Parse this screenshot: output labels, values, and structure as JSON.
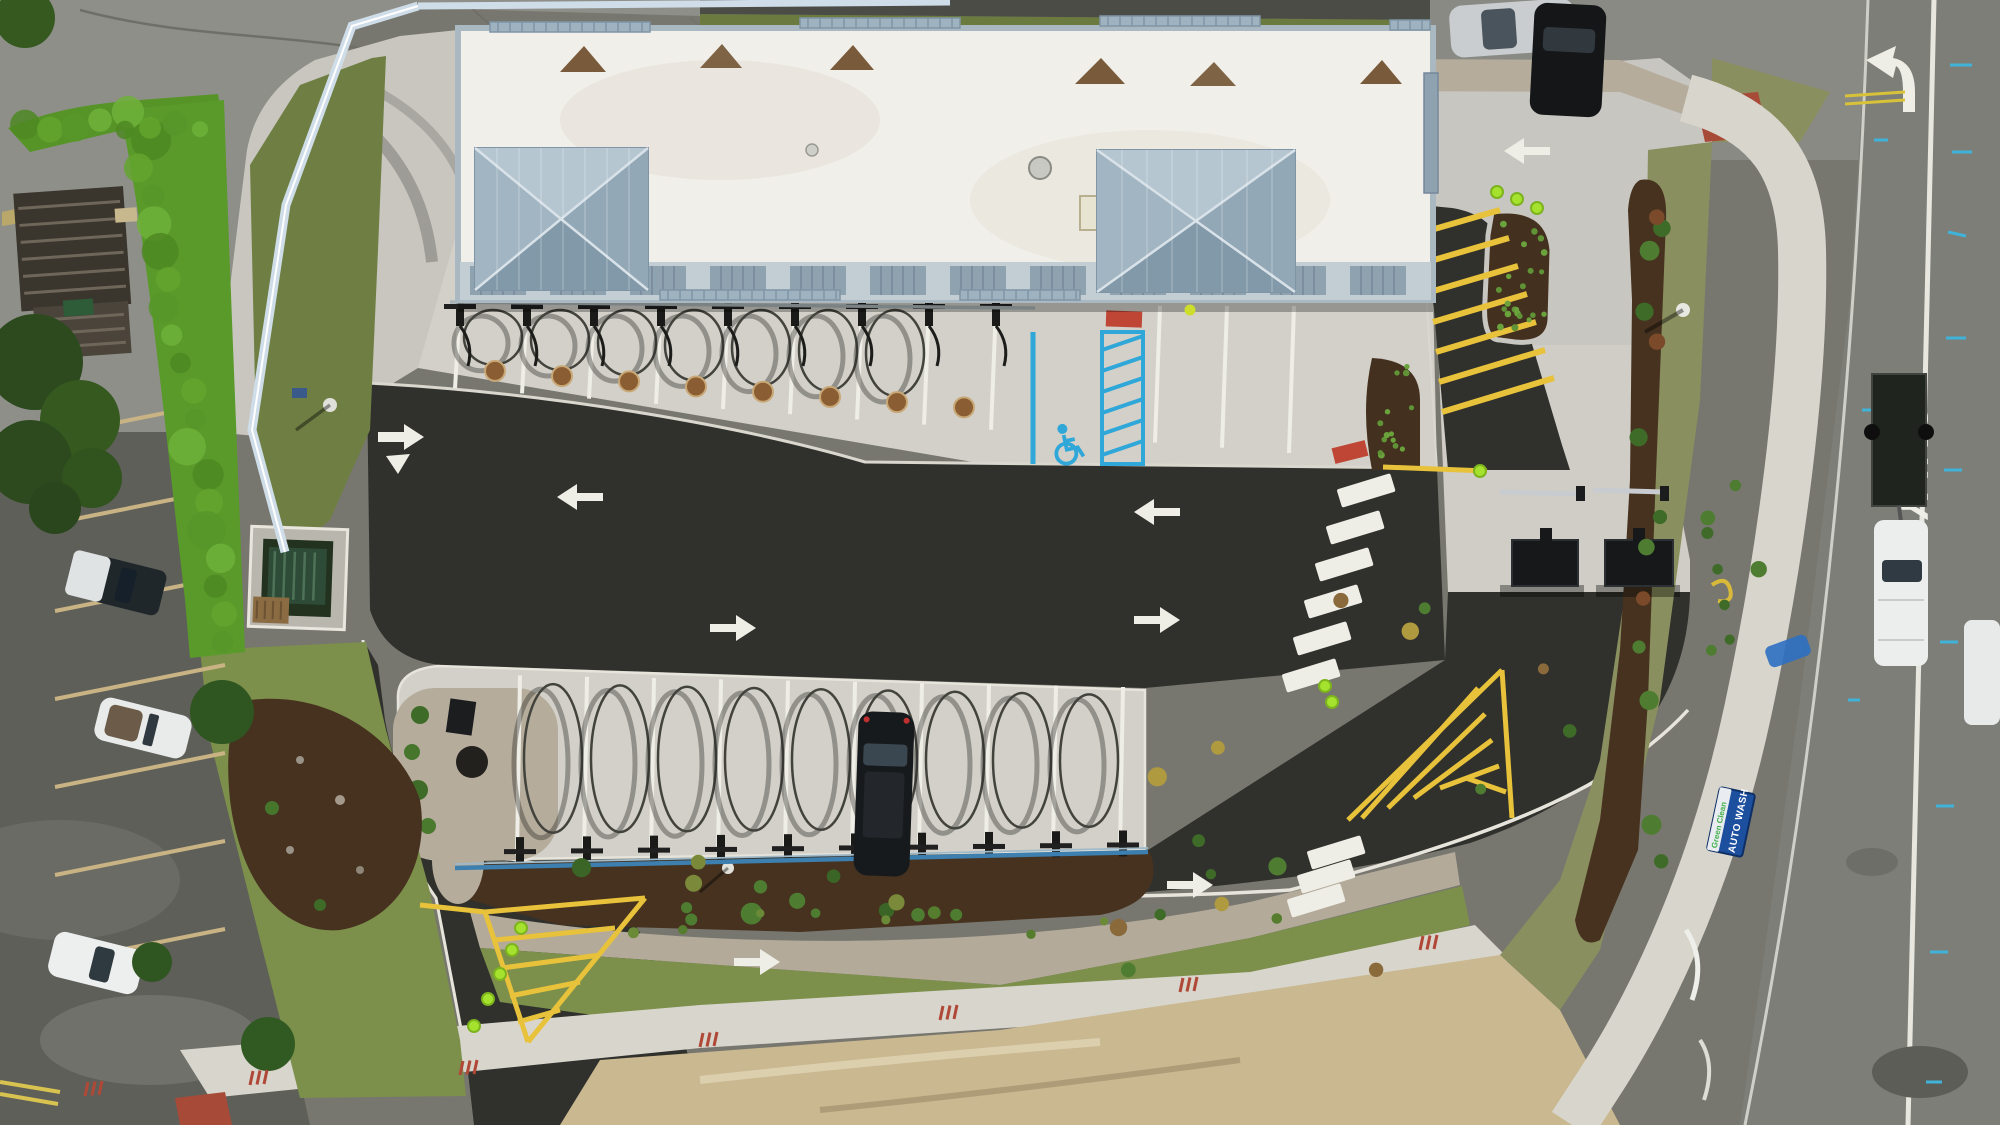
{
  "scene": {
    "title": "Aerial drone view of a car wash facility with vacuum stations, drive lanes and adjacent street",
    "street_marking_text": "ONLY",
    "monument_sign": {
      "line1": "Green Clean",
      "line2": "AUTO WASH"
    },
    "colors": {
      "old_asphalt": "#8f8f8a",
      "left_lot_asphalt": "#5e5f59",
      "new_asphalt": "#30312c",
      "concrete": "#d2d0c8",
      "concrete_dim": "#c8c6bf",
      "white_roof": "#f1efe9",
      "parapet": "#aab8c2",
      "louver": "#8fa2af",
      "tower_roof": "#9db1bf",
      "hedge_green": "#5a9a2b",
      "grass": "#7c8f4b",
      "dry_grass": "#8a8f5f",
      "mulch": "#46321f",
      "gravel": "#b5ac9c",
      "sand": "#c9b890",
      "marking_white": "#efeee6",
      "accessible_blue": "#2fa7d9",
      "hazard_yellow": "#e8c23a",
      "safety_red": "#bf4534",
      "cone_green": "#a5e22e",
      "fence_white": "#cfdde9",
      "sign_blue": "#1c4f9e",
      "sign_green": "#43b04a",
      "street_asphalt": "#7e7e79"
    },
    "counts": {
      "top_row_vacuum_arches": 7,
      "bottom_row_vacuum_arches": 9,
      "top_row_parking_stripes": 12,
      "bottom_row_parking_stripes": 10,
      "left_lot_parking_stripes": 7,
      "crosswalk_bars_main": 6,
      "crosswalk_bars_south": 3,
      "accessible_hatch_lines": 6,
      "northeast_hatch_stripes": 7,
      "southeast_hatch_stripes": 5,
      "entrance_hatch_stripes": 4,
      "traffic_cones": 11,
      "right_verge_shrubs": 14,
      "south_bed_shrubs": 10,
      "louver_segments": 12
    },
    "pavement_icons": [
      "left-lane-arrow-icon",
      "right-lane-arrow-icon",
      "accessible-parking-icon",
      "left-turn-arrow-icon",
      "yield-triangle-icon"
    ],
    "vehicles": {
      "silver_car": "parked, top right pavement",
      "black_car": "on street, top right",
      "black_suv": "parked at bottom vacuum row",
      "white_pickup_with_trailer": "on street, right side",
      "white_truck_partial": "right edge of street",
      "dark_pickup_camper": "left lot",
      "white_convertible": "left lot",
      "white_suv": "left lot"
    }
  }
}
